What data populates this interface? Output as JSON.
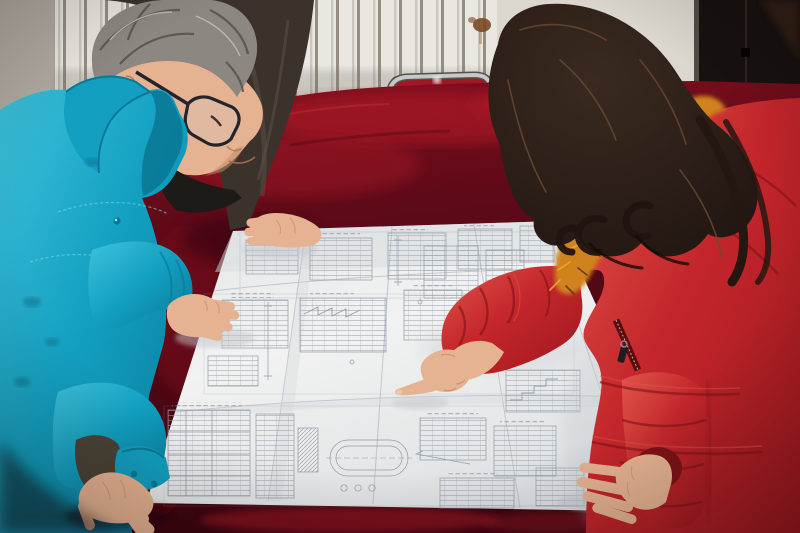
{
  "meta": {
    "alt": "Three people lean over a large folded construction blueprint spread on a table covered with dark red velvet; a man in a teal work jacket studies it while a woman in a red fur-trimmed down coat points at a detail",
    "width": 800,
    "height": 533
  },
  "palette": {
    "wall-left": "#b1aba1",
    "radiator-light": "#eae7e0",
    "radiator-shade": "#cbc7bf",
    "radiator-gap": "#948e82",
    "wall-right": "#dcd7ce",
    "rust": "#7b4a22",
    "dark-wall": "#171110",
    "dark-wall-warm": "#392318",
    "chair-red": "#a21724",
    "chair-frame": "#c6c8ca",
    "velvet-top": "#8c101e",
    "velvet-mid": "#5f0a18",
    "velvet-deep": "#3c050f",
    "velvet-sheen": "#b51a2c",
    "velvet-edge": "#c23343",
    "paper-light": "#f1f2f1",
    "paper-mid": "#e4e6e8",
    "paper-shade": "#cfd3d7",
    "line-ink": "#8a94a2",
    "teal-main": "#129fc0",
    "teal-dark": "#0a7997",
    "teal-light": "#3ec2dc",
    "stitch": "#79d8ea",
    "hair-gray": "#8c8780",
    "hair-gray-dark": "#534e48",
    "skin": "#e6b392",
    "skin-shadow": "#bf8a66",
    "jacket-dark": "#3a322b",
    "jacket-dark-light": "#5a5247",
    "shirt-dark": "#1d1a18",
    "coat-red": "#c4262b",
    "coat-red-light": "#e0564a",
    "coat-red-dark": "#7e1317",
    "fur-orange": "#d0821f",
    "fur-dark": "#64370c",
    "hair-black": "#1f1410",
    "hair-brown": "#6a4a32",
    "shadow-cool": "#c2c7cd"
  },
  "scene": {
    "people": [
      {
        "id": "worker-teal",
        "label": "Worker in teal jacket with glasses studying the blueprint"
      },
      {
        "id": "colleague-dark",
        "label": "Colleague in dark jacket resting a hand on the blueprint"
      },
      {
        "id": "woman-red",
        "label": "Woman in red down coat with fur hood pointing at the blueprint"
      }
    ],
    "objects": [
      {
        "id": "blueprint",
        "label": "Large folded construction blueprint with technical detail drawings"
      },
      {
        "id": "table",
        "label": "Table draped in dark red velvet"
      },
      {
        "id": "radiator",
        "label": "White wall radiator with vertical fins"
      },
      {
        "id": "chair",
        "label": "Metal framed chair with red backrest"
      },
      {
        "id": "dark-wall",
        "label": "Dark wall panel at right"
      }
    ]
  }
}
